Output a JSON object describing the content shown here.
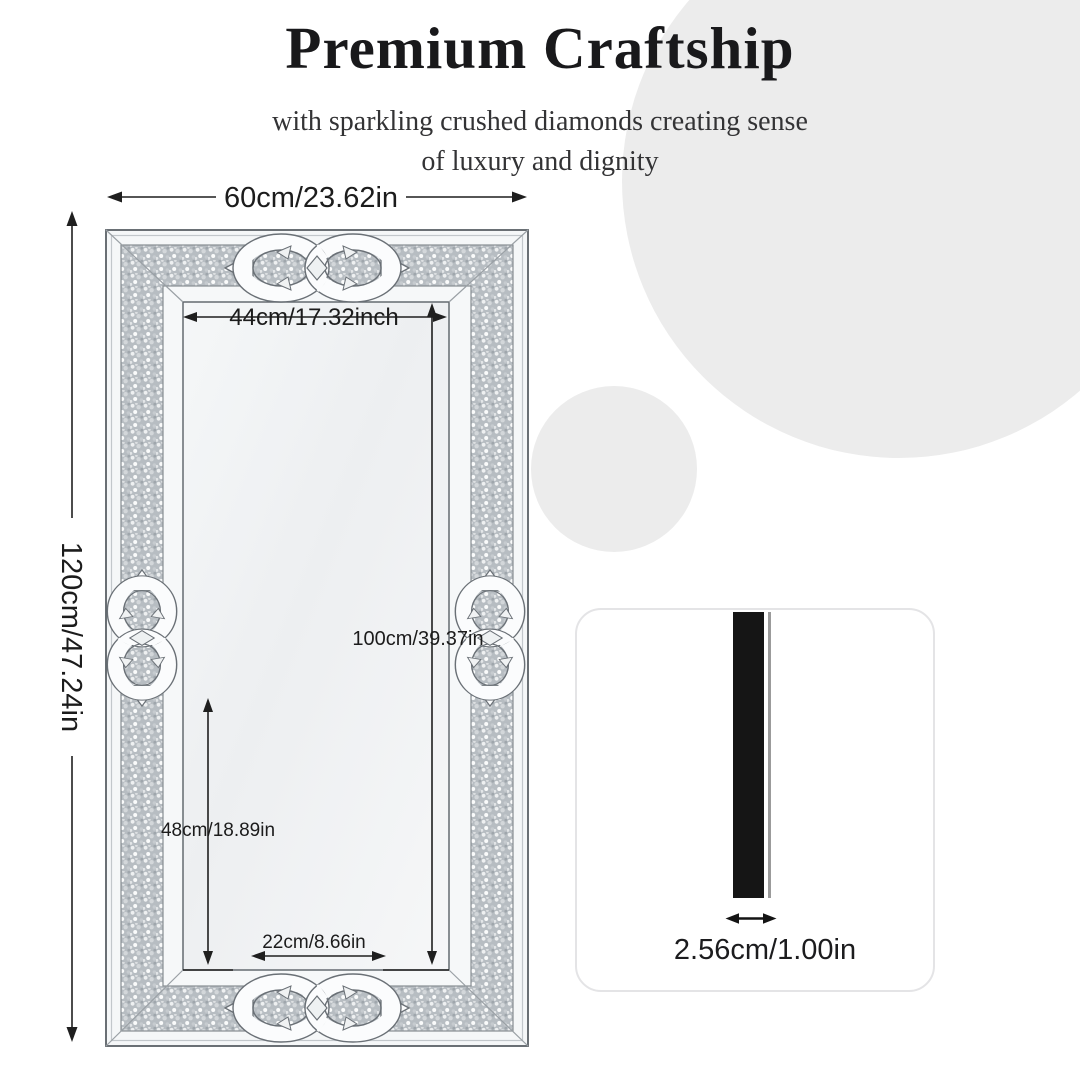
{
  "header": {
    "title": "Premium Craftship",
    "subtitle_line1": "with sparkling crushed diamonds creating sense",
    "subtitle_line2": "of luxury and dignity"
  },
  "dimensions": {
    "overall_width": "60cm/23.62in",
    "overall_height": "120cm/47.24in",
    "inner_width": "44cm/17.32inch",
    "inner_height": "100cm/39.37in",
    "lower_height": "48cm/18.89in",
    "bottom_width": "22cm/8.66in",
    "thickness": "2.56cm/1.00in"
  },
  "colors": {
    "background": "#ffffff",
    "decor_circle": "#ececec",
    "dimension_line": "#1f1f1f",
    "frame_outline": "#5a6066",
    "crushed_band_base": "#b7bdc2",
    "mirror_face": "#f0f2f3",
    "side_bar": "#151515",
    "side_bar_edge": "#9b9b9b",
    "card_border": "#e4e4e6",
    "card_background": "#ffffff"
  }
}
